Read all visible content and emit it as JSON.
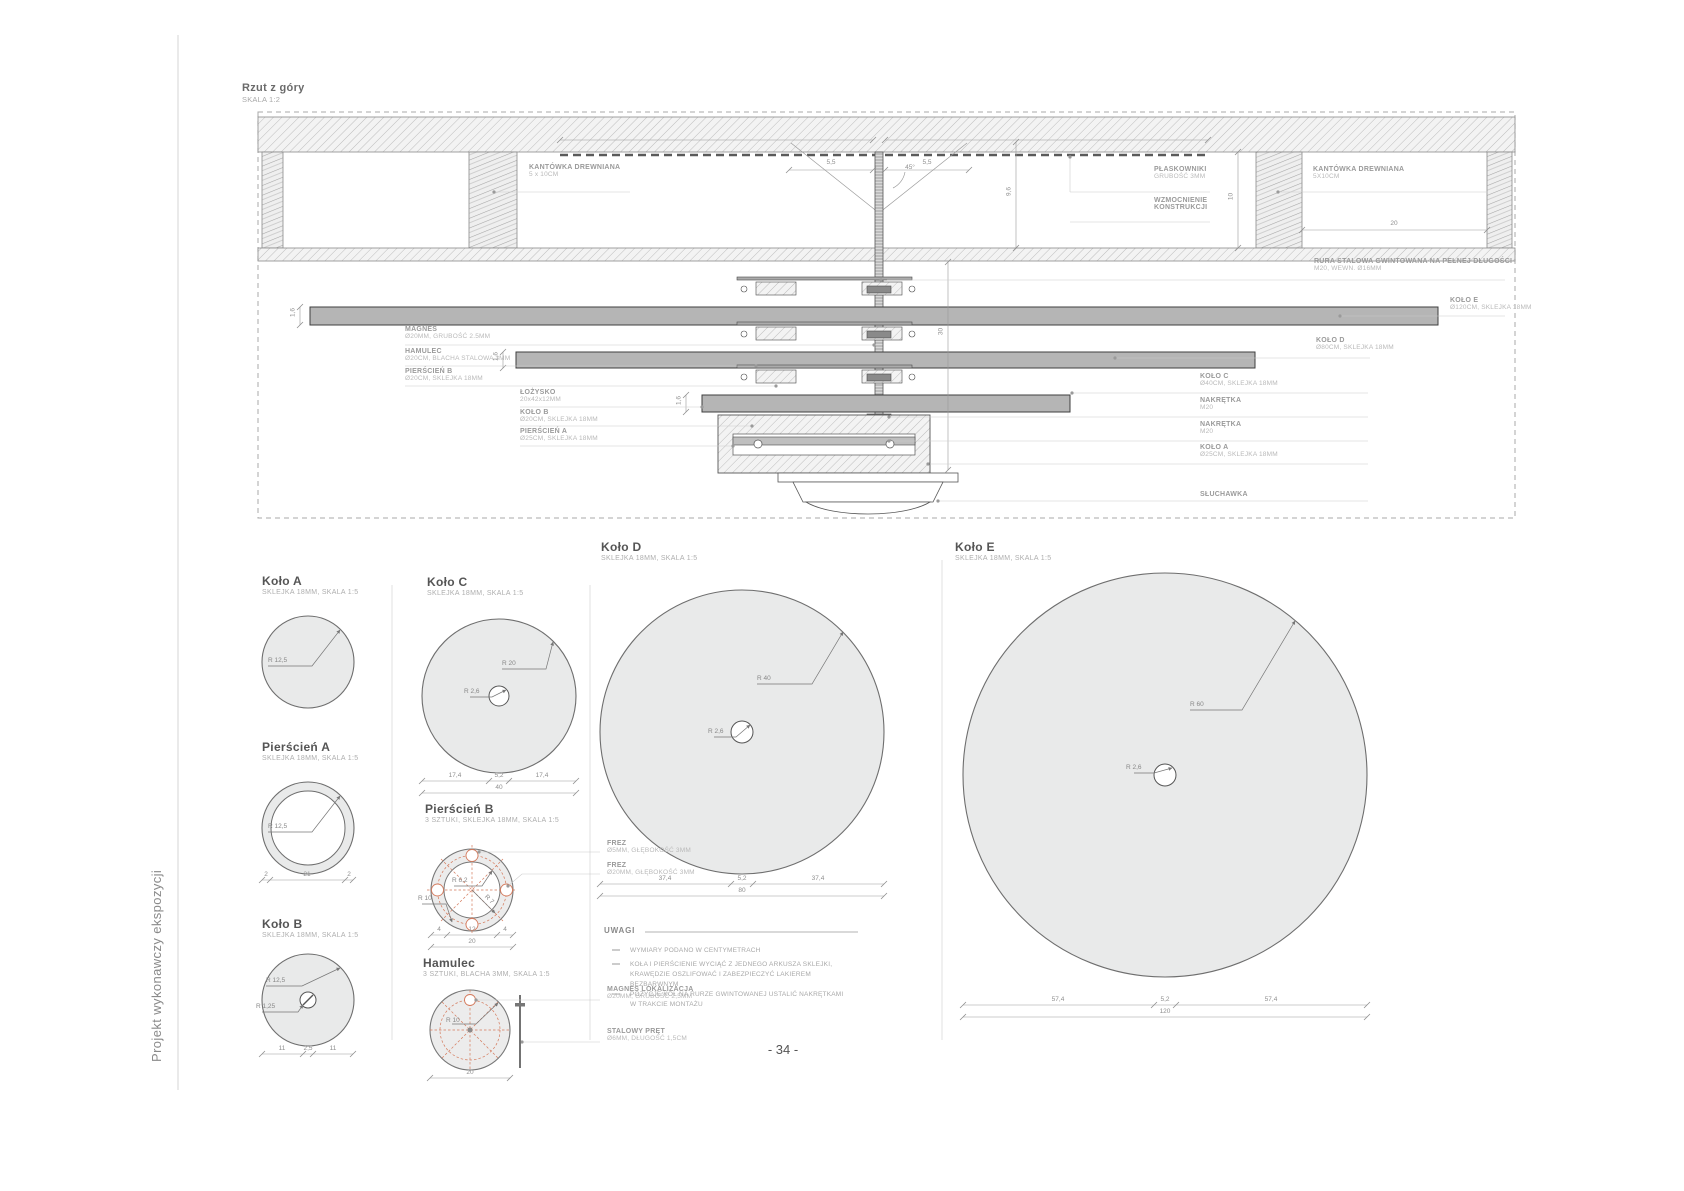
{
  "page": {
    "side_label": "Projekt wykonawczy ekspozycji",
    "page_number": "- 34 -"
  },
  "top_view": {
    "title": "Rzut z góry",
    "scale": "SKALA 1:2",
    "labels": {
      "kantowka_left": {
        "t": "KANTÓWKA DREWNIANA",
        "s": "5 x 10CM"
      },
      "magnes": {
        "t": "MAGNES",
        "s": "Ø20MM, GRUBOŚĆ 2.5MM"
      },
      "hamulec": {
        "t": "HAMULEC",
        "s": "Ø20CM, BLACHA STALOWA 3MM"
      },
      "pierscien_b": {
        "t": "PIERŚCIEŃ B",
        "s": "Ø20CM, SKLEJKA 18MM"
      },
      "lozysko": {
        "t": "ŁOŻYSKO",
        "s": "20x42x12MM"
      },
      "kolo_b": {
        "t": "KOŁO B",
        "s": "Ø20CM, SKLEJKA 18MM"
      },
      "pierscien_a": {
        "t": "PIERŚCIEŃ A",
        "s": "Ø25CM, SKLEJKA 18MM"
      },
      "plaskowniki": {
        "t": "PŁASKOWNIKI",
        "s": "GRUBOŚĆ 3MM"
      },
      "wzmocnienie": {
        "t": "WZMOCNIENIE",
        "t2": "KONSTRUKCJI"
      },
      "kantowka_right": {
        "t": "KANTÓWKA DREWNIANA",
        "s": "5X10CM"
      },
      "rura": {
        "t": "RURA STALOWA GWINTOWANA NA PEŁNEJ DŁUGOŚCI",
        "s": "M20, WEWN. Ø16MM"
      },
      "kolo_e": {
        "t": "KOŁO E",
        "s": "Ø120CM, SKLEJKA 18MM"
      },
      "kolo_d": {
        "t": "KOŁO D",
        "s": "Ø80CM, SKLEJKA 18MM"
      },
      "kolo_c": {
        "t": "KOŁO C",
        "s": "Ø40CM, SKLEJKA 18MM"
      },
      "nakretka1": {
        "t": "NAKRĘTKA",
        "s": "M20"
      },
      "nakretka2": {
        "t": "NAKRĘTKA",
        "s": "M20"
      },
      "kolo_a": {
        "t": "KOŁO A",
        "s": "Ø25CM, SKLEJKA 18MM"
      },
      "sluchawka": {
        "t": "SŁUCHAWKA"
      }
    },
    "dims": {
      "w1": "5,5",
      "w2": "5,5",
      "angle": "45°",
      "h1": "9,6",
      "h2": "10",
      "len": "20",
      "stack": "30",
      "th1": "1,6",
      "th2": "1,6",
      "th3": "1,6"
    }
  },
  "sections": {
    "kolo_a": {
      "title": "Koło A",
      "sub": "SKLEJKA 18MM, SKALA 1:5",
      "r1": "R 12,5"
    },
    "pierscien_a": {
      "title": "Pierścień A",
      "sub": "SKLEJKA 18MM, SKALA 1:5",
      "r1": "R 12,5",
      "dims": [
        "2",
        "21",
        "2"
      ]
    },
    "kolo_b": {
      "title": "Koło B",
      "sub": "SKLEJKA 18MM, SKALA 1:5",
      "r1": "R 12,5",
      "r2": "R 1,25",
      "dims": [
        "11",
        "2,5",
        "11"
      ]
    },
    "kolo_c": {
      "title": "Koło C",
      "sub": "SKLEJKA 18MM, SKALA 1:5",
      "r1": "R 20",
      "r2": "R 2,6",
      "dims": [
        "17,4",
        "5,2",
        "17,4"
      ],
      "total": "40"
    },
    "pierscien_b": {
      "title": "Pierścień B",
      "sub": "3 SZTUKI, SKLEJKA 18MM, SKALA 1:5",
      "r1": "R 6,2",
      "r2": "R 10",
      "r3": "R 7",
      "frez1": {
        "t": "FREZ",
        "s": "Ø5MM, GŁĘBOKOŚĆ 3MM"
      },
      "frez2": {
        "t": "FREZ",
        "s": "Ø20MM, GŁĘBOKOŚĆ 3MM"
      },
      "dims": [
        "4",
        "12",
        "4"
      ],
      "total": "20"
    },
    "hamulec": {
      "title": "Hamulec",
      "sub": "3 SZTUKI, BLACHA 3MM, SKALA 1:5",
      "r1": "R 10",
      "magnes": {
        "t": "MAGNES LOKALIZACJA",
        "s": "Ø20MM, GRUBOŚĆ 2,5MM"
      },
      "pret": {
        "t": "STALOWY PRĘT",
        "s": "Ø6MM, DŁUGOŚĆ 1,5CM"
      },
      "total": "20"
    },
    "kolo_d": {
      "title": "Koło D",
      "sub": "SKLEJKA 18MM, SKALA 1:5",
      "r1": "R 40",
      "r2": "R 2,6",
      "dims": [
        "37,4",
        "5,2",
        "37,4"
      ],
      "total": "80"
    },
    "kolo_e": {
      "title": "Koło E",
      "sub": "SKLEJKA 18MM, SKALA 1:5",
      "r1": "R 60",
      "r2": "R 2,6",
      "dims": [
        "57,4",
        "5,2",
        "57,4"
      ],
      "total": "120"
    }
  },
  "uwagi": {
    "title": "UWAGI",
    "notes": [
      "WYMIARY PODANO W CENTYMETRACH",
      "KOŁA I PIERŚCIENIE WYCIĄĆ Z JEDNEGO ARKUSZA SKLEJKI, KRAWĘDZIE OSZLIFOWAĆ I ZABEZPIECZYĆ LAKIEREM BEZBARWNYM",
      "POZYCJE KÓŁ NA RURZE GWINTOWANEJ USTALIĆ NAKRĘTKAMI W TRAKCIE MONTAŻU"
    ]
  }
}
